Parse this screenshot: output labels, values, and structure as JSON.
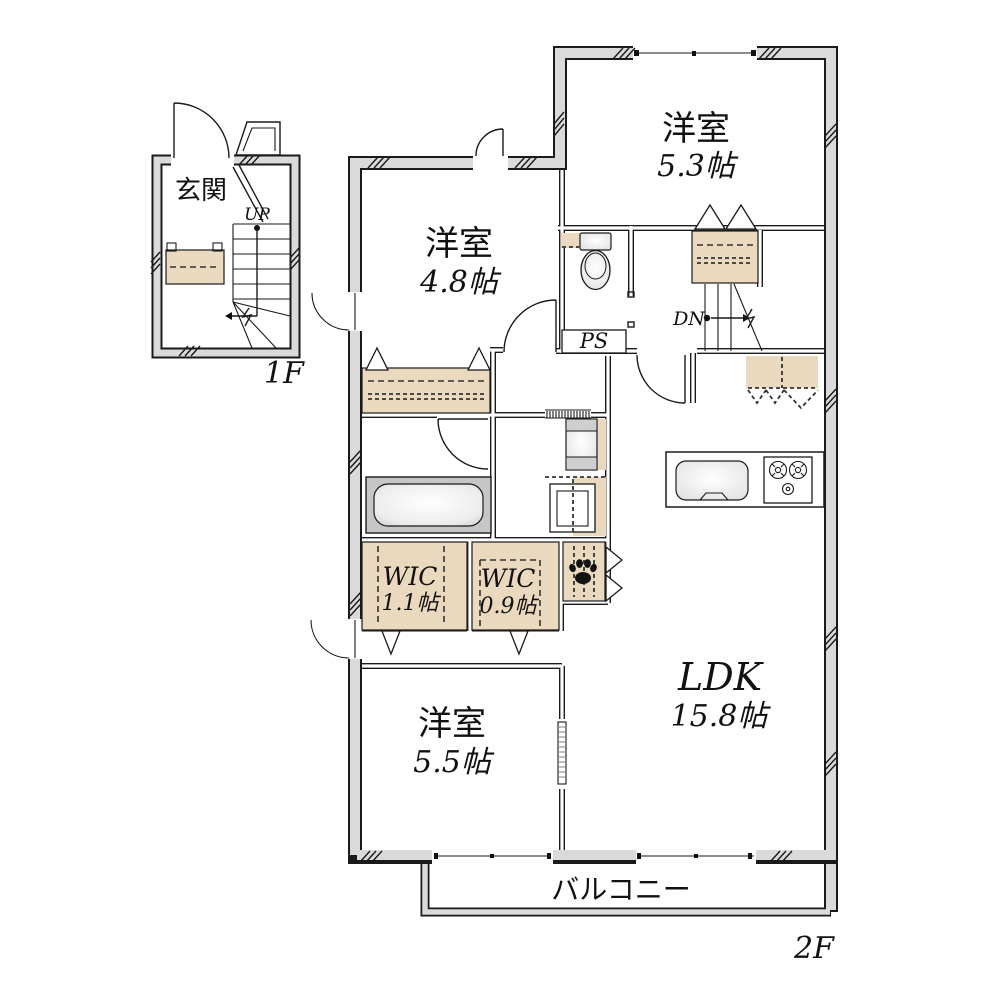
{
  "floor1": {
    "floor_label": "1F",
    "genkan_label": "玄関",
    "stairs_up_label": "UP"
  },
  "floor2": {
    "floor_label": "2F",
    "bedroom_ne": {
      "name": "洋室",
      "size": "5.3帖"
    },
    "bedroom_nw": {
      "name": "洋室",
      "size": "4.8帖"
    },
    "bedroom_sw": {
      "name": "洋室",
      "size": "5.5帖"
    },
    "ldk": {
      "name": "LDK",
      "size": "15.8帖"
    },
    "wic_a": {
      "name": "WIC",
      "size": "1.1帖"
    },
    "wic_b": {
      "name": "WIC",
      "size": "0.9帖"
    },
    "stairs_down_label": "DN",
    "pipe_space_label": "PS",
    "balcony_label": "バルコニー"
  },
  "colors": {
    "wall_fill": "#dadada",
    "outline": "#1a1a1a",
    "closet_fill": "#ead9be",
    "tub_surround": "#c6c6c6"
  }
}
